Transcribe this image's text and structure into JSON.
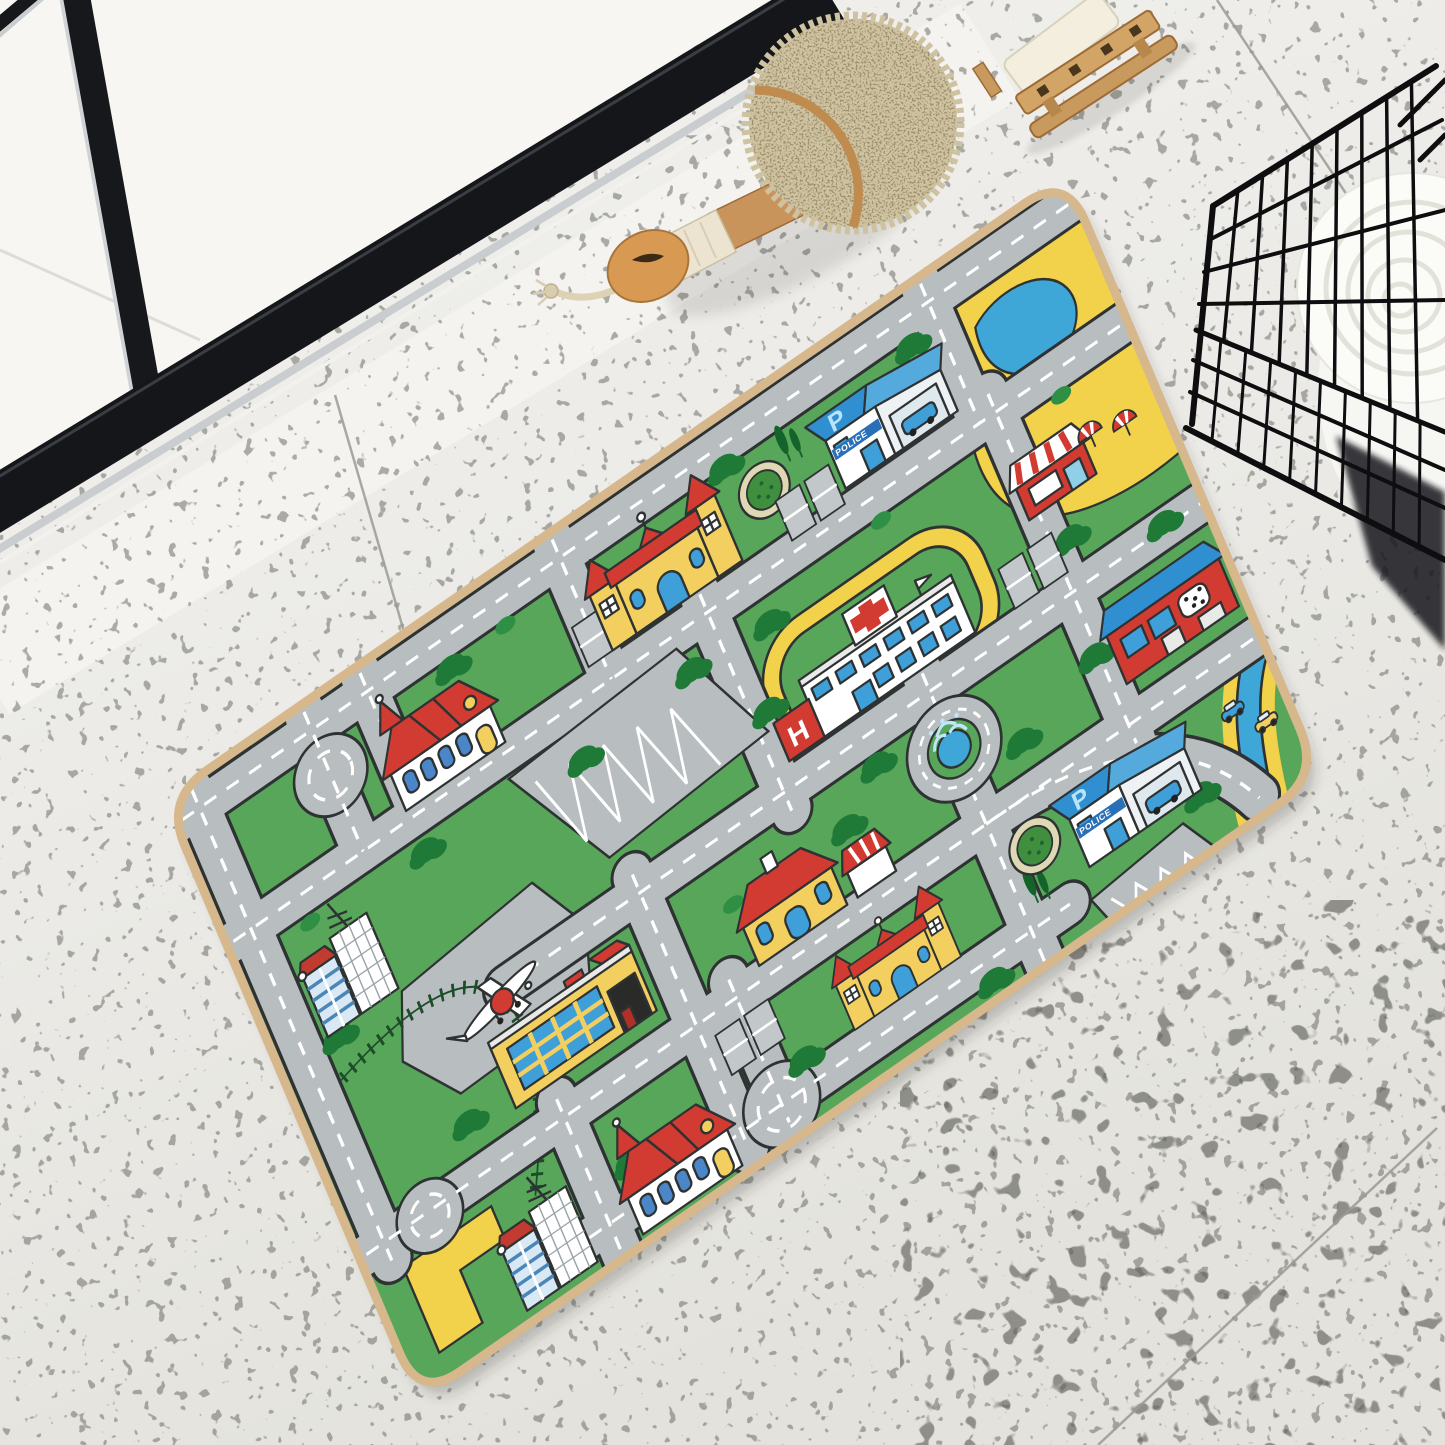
{
  "scene": {
    "description_labels": {
      "police_station": "POLICE",
      "parking_roof": "P",
      "hospital_wing": "H"
    },
    "floor": {
      "base_color": "#efeeea",
      "shade_color": "#e2e1db",
      "speckle_color": "#6f6f69",
      "tile_seam_color": "#9b9a94"
    },
    "door": {
      "frame_color": "#17181b",
      "glass_color": "#f7f6f2",
      "chrome_color": "#c9cdd0",
      "sill_color": "#f4f3ef"
    },
    "bath_brush": {
      "bristle_color": "#cfc2a0",
      "wood_color": "#c9945c",
      "wrap_color": "#ece4d0",
      "rope_color": "#ded2b4"
    },
    "soap_rack": {
      "wood_color": "#c89a5e",
      "soap_color": "#f3eedd"
    },
    "wire_basket": {
      "wire_color": "#0e0e10"
    },
    "towel": {
      "color": "#fbfbf8"
    },
    "mat": {
      "labels": {
        "police": "POLICE",
        "parking": "P",
        "hospital": "H"
      },
      "colors": {
        "grass": "#57a65a",
        "road": "#b8bdbf",
        "road_dash": "#ffffff",
        "outline": "#2e3233",
        "sand": "#f2d14b",
        "water": "#3fa6d8",
        "roof_red": "#d23b31",
        "roof_blue": "#2f8fd0",
        "wall_yellow": "#f2cf5e",
        "wall_white": "#ffffff",
        "tree_green": "#1e7a36",
        "binding": "#d6b88c"
      }
    }
  }
}
